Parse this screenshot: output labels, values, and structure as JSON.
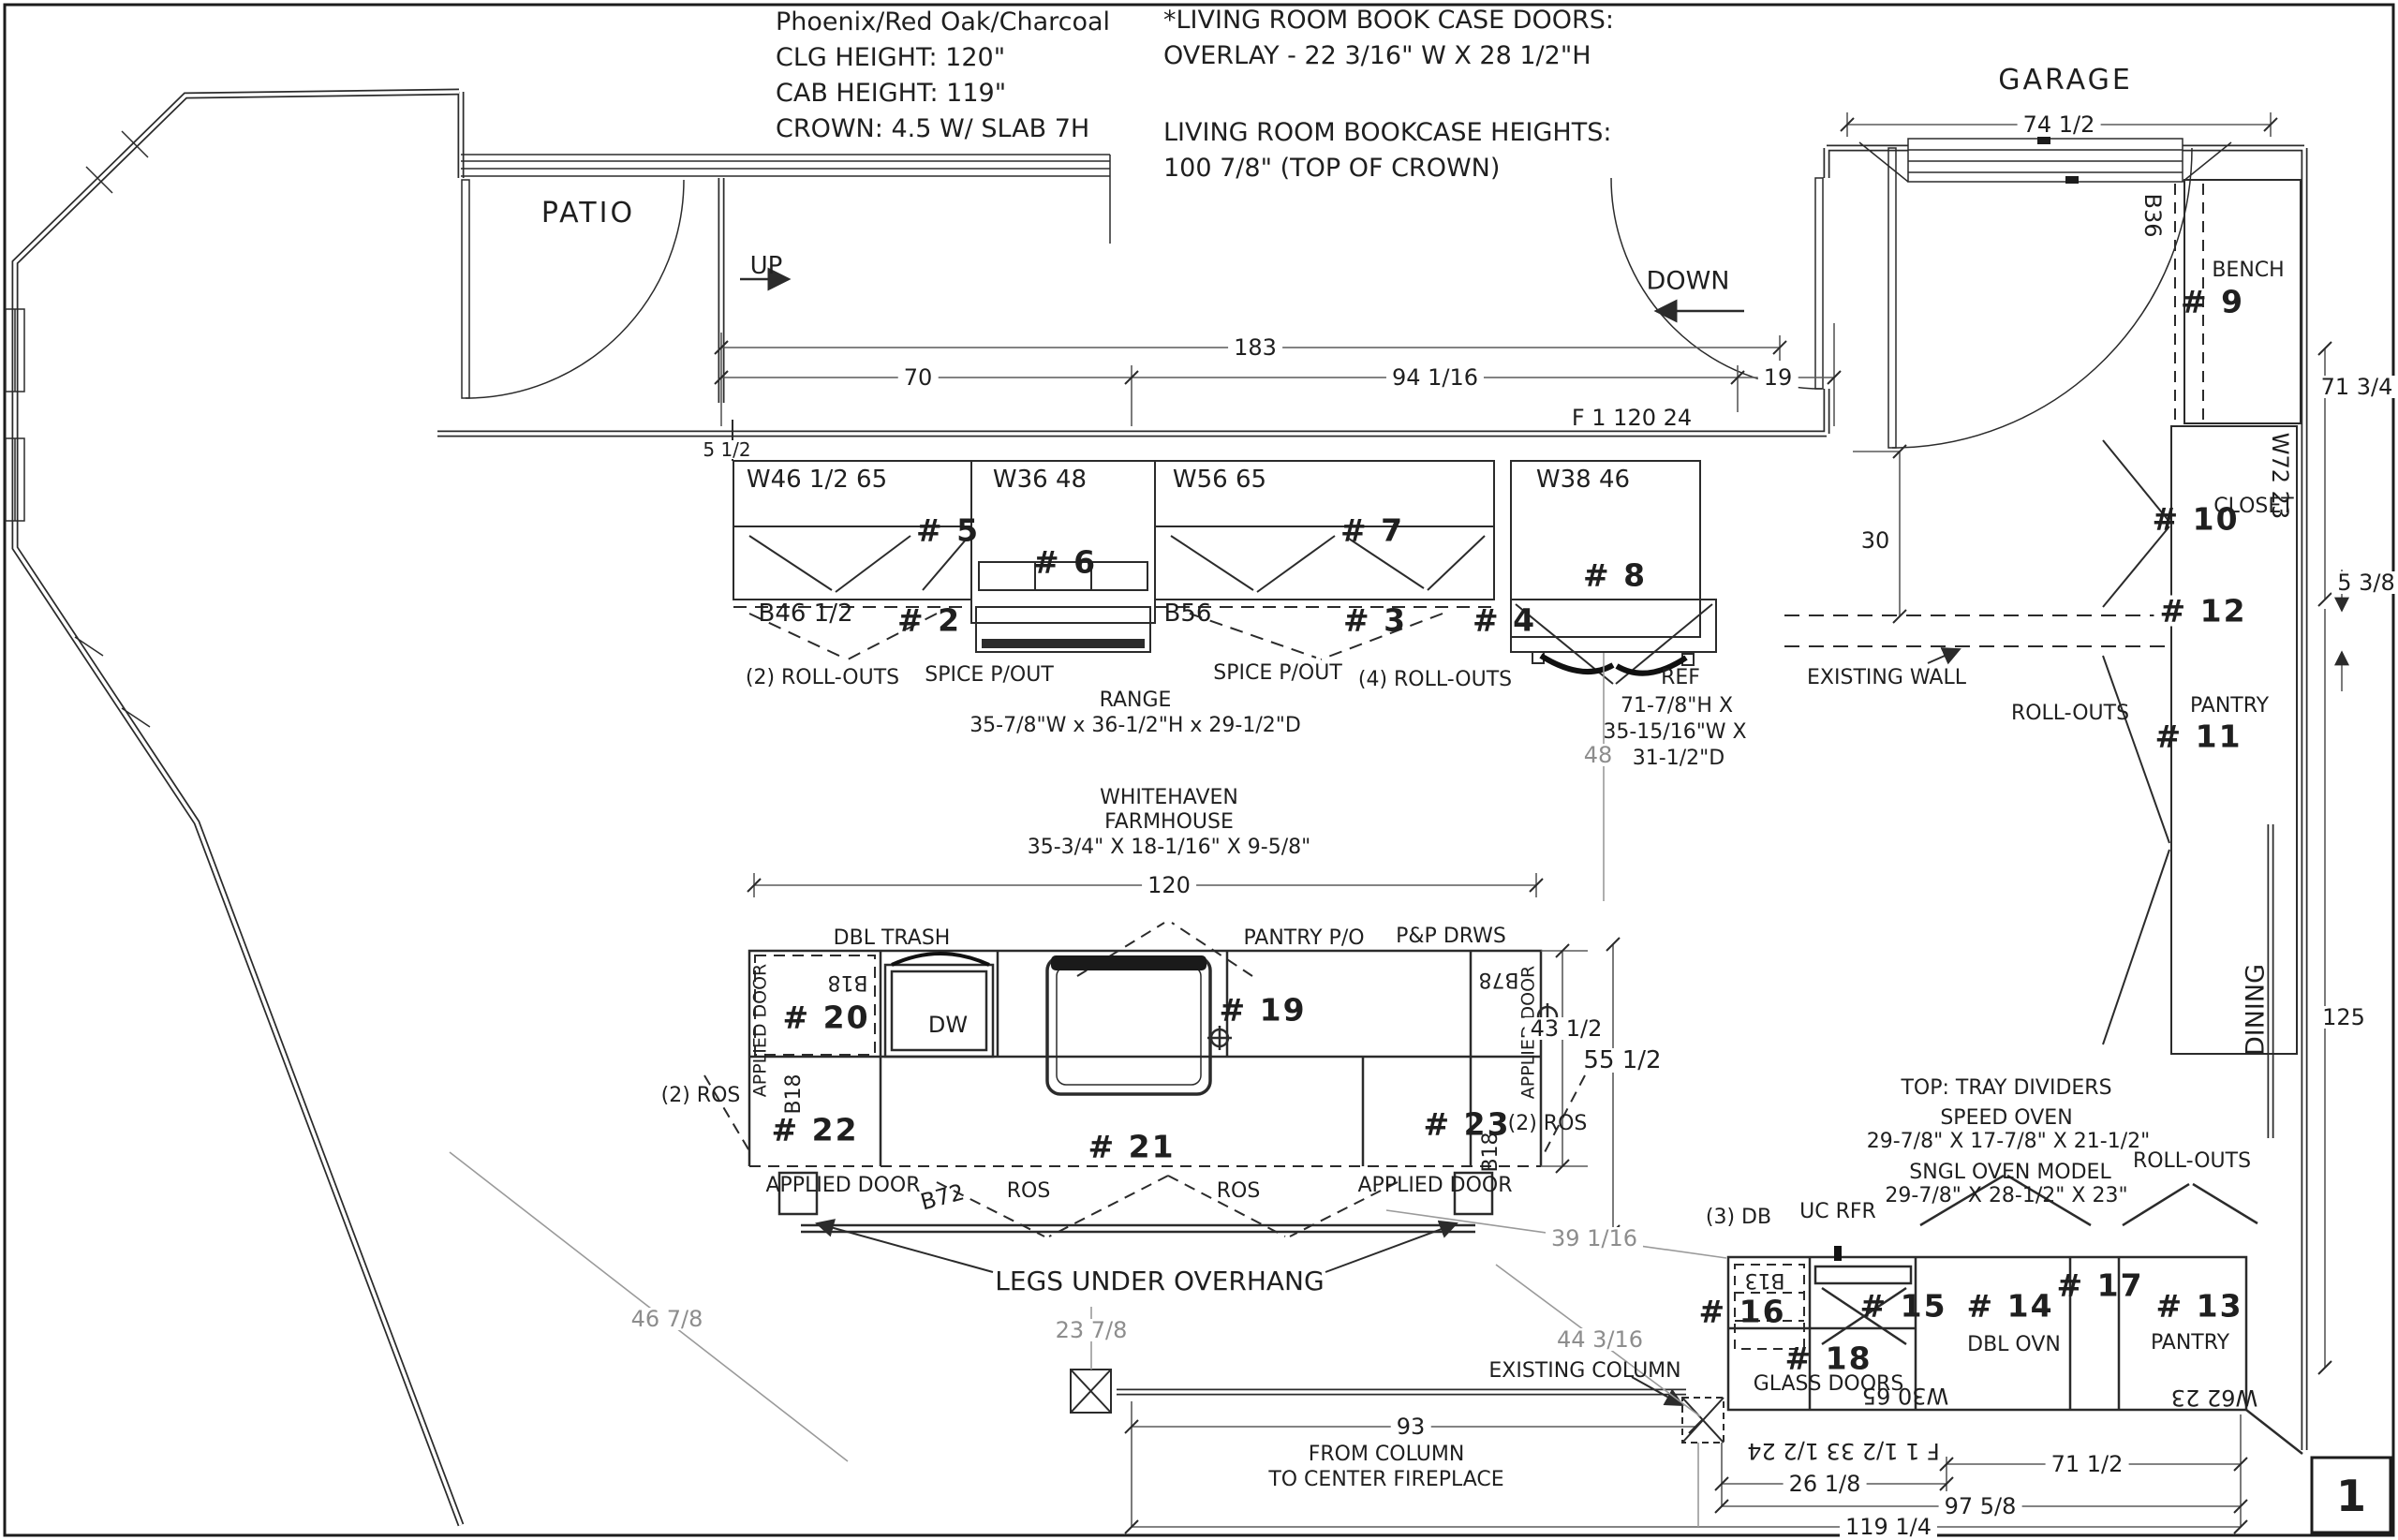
{
  "sheet": {
    "page_number": "1"
  },
  "notes_left": {
    "line1": "Phoenix/Red Oak/Charcoal",
    "line2": "CLG HEIGHT: 120\"",
    "line3": "CAB HEIGHT: 119\"",
    "line4": "CROWN: 4.5 W/ SLAB 7H"
  },
  "notes_right": {
    "line1": "*LIVING ROOM BOOK CASE DOORS:",
    "line2": "OVERLAY - 22 3/16\" W X 28 1/2\"H",
    "line3": "LIVING ROOM BOOKCASE HEIGHTS:",
    "line4": "100 7/8\" (TOP OF CROWN)"
  },
  "rooms": {
    "patio": "PATIO",
    "garage": "GARAGE",
    "dining": "DINING"
  },
  "stairs": {
    "up": "UP",
    "down": "DOWN"
  },
  "annotations": {
    "existing_wall": "EXISTING WALL",
    "existing_column": "EXISTING COLUMN",
    "legs_note": "LEGS UNDER OVERHANG",
    "from_column_1": "FROM COLUMN",
    "from_column_2": "TO CENTER FIREPLACE"
  },
  "dimensions": {
    "top_overall": "183",
    "top_left": "70",
    "top_mid": "94 1/16",
    "top_right": "19",
    "wall_tag_top": "F 1 120 24",
    "filler": "5 1/2",
    "garage_opening": "74 1/2",
    "right_upper": "71 3/4",
    "fridge_recess": "30",
    "wall_gap": "5 3/8",
    "dining_height": "125",
    "island_length": "120",
    "aisle": "48",
    "island_depth": "43 1/2",
    "island_overall": "55 1/2",
    "clearance_left": "46 7/8",
    "clearance_center": "23 7/8",
    "clearance_right": "44 3/16",
    "clearance_diag": "39 1/16",
    "to_fireplace": "93",
    "col_to_cab": "26 1/8",
    "bottom_inner": "71 1/2",
    "bottom_mid": "97 5/8",
    "bottom_overall": "119 1/4",
    "wall_tag_bottom": "F 1 1/2 33 1/2 24"
  },
  "upper_run": {
    "w46": "W46 1/2 65",
    "no5": "# 5",
    "b46": "B46 1/2",
    "no2": "# 2",
    "rollouts2": "(2) ROLL-OUTS",
    "spice1": "SPICE P/OUT",
    "w36": "W36 48",
    "no6": "# 6",
    "range": "RANGE",
    "range_size": "35-7/8\"W x 36-1/2\"H x 29-1/2\"D",
    "w56": "W56 65",
    "no7": "# 7",
    "b56": "B56",
    "no3": "# 3",
    "no4": "# 4",
    "spice2": "SPICE P/OUT",
    "rollouts4": "(4) ROLL-OUTS",
    "w38": "W38 46",
    "no8": "# 8",
    "ref": "REF",
    "ref_h": "71-7/8\"H X",
    "ref_w": "35-15/16\"W X",
    "ref_d": "31-1/2\"D"
  },
  "mudroom": {
    "b36": "B36",
    "bench": "BENCH",
    "no9": "# 9",
    "w72": "W72 23",
    "no10": "# 10",
    "closet": "CLOSET",
    "no12": "# 12",
    "rollouts": "ROLL-OUTS",
    "pantry": "PANTRY",
    "no11": "# 11"
  },
  "island": {
    "sink1": "WHITEHAVEN",
    "sink2": "FARMHOUSE",
    "sink3": "35-3/4\" X 18-1/16\" X 9-5/8\"",
    "dbl_trash": "DBL TRASH",
    "pantry_po": "PANTRY P/O",
    "pp_drws": "P&P DRWS",
    "b18a": "B18",
    "no20": "# 20",
    "dw": "DW",
    "no19": "# 19",
    "b78": "B78",
    "applied_l": "APPLIED DOOR",
    "applied_r": "APPLIED DOOR",
    "b18b": "B18",
    "no22": "# 22",
    "no21": "# 21",
    "no23": "# 23",
    "b18c": "B18",
    "ros2l": "(2) ROS",
    "ros2r": "(2) ROS",
    "applied_bl": "APPLIED DOOR",
    "b72": "B72",
    "ros1": "ROS",
    "ros2": "ROS",
    "applied_br": "APPLIED DOOR"
  },
  "oven_wall": {
    "tray": "TOP: TRAY DIVIDERS",
    "speed": "SPEED OVEN",
    "speed_size": "29-7/8\" X 17-7/8\" X 21-1/2\"",
    "sngl": "SNGL OVEN MODEL",
    "sngl_size": "29-7/8\" X 28-1/2\" X 23\"",
    "rollouts": "ROLL-OUTS",
    "db3": "(3) DB",
    "ucrfr": "UC RFR",
    "b13": "B13",
    "no16": "# 16",
    "no15": "# 15",
    "no14": "# 14",
    "no17": "# 17",
    "no13": "# 13",
    "dbl_ovn": "DBL OVN",
    "pantry": "PANTRY",
    "no18": "# 18",
    "glass": "GLASS DOORS",
    "w30": "W30 65",
    "w62": "W62 23"
  }
}
